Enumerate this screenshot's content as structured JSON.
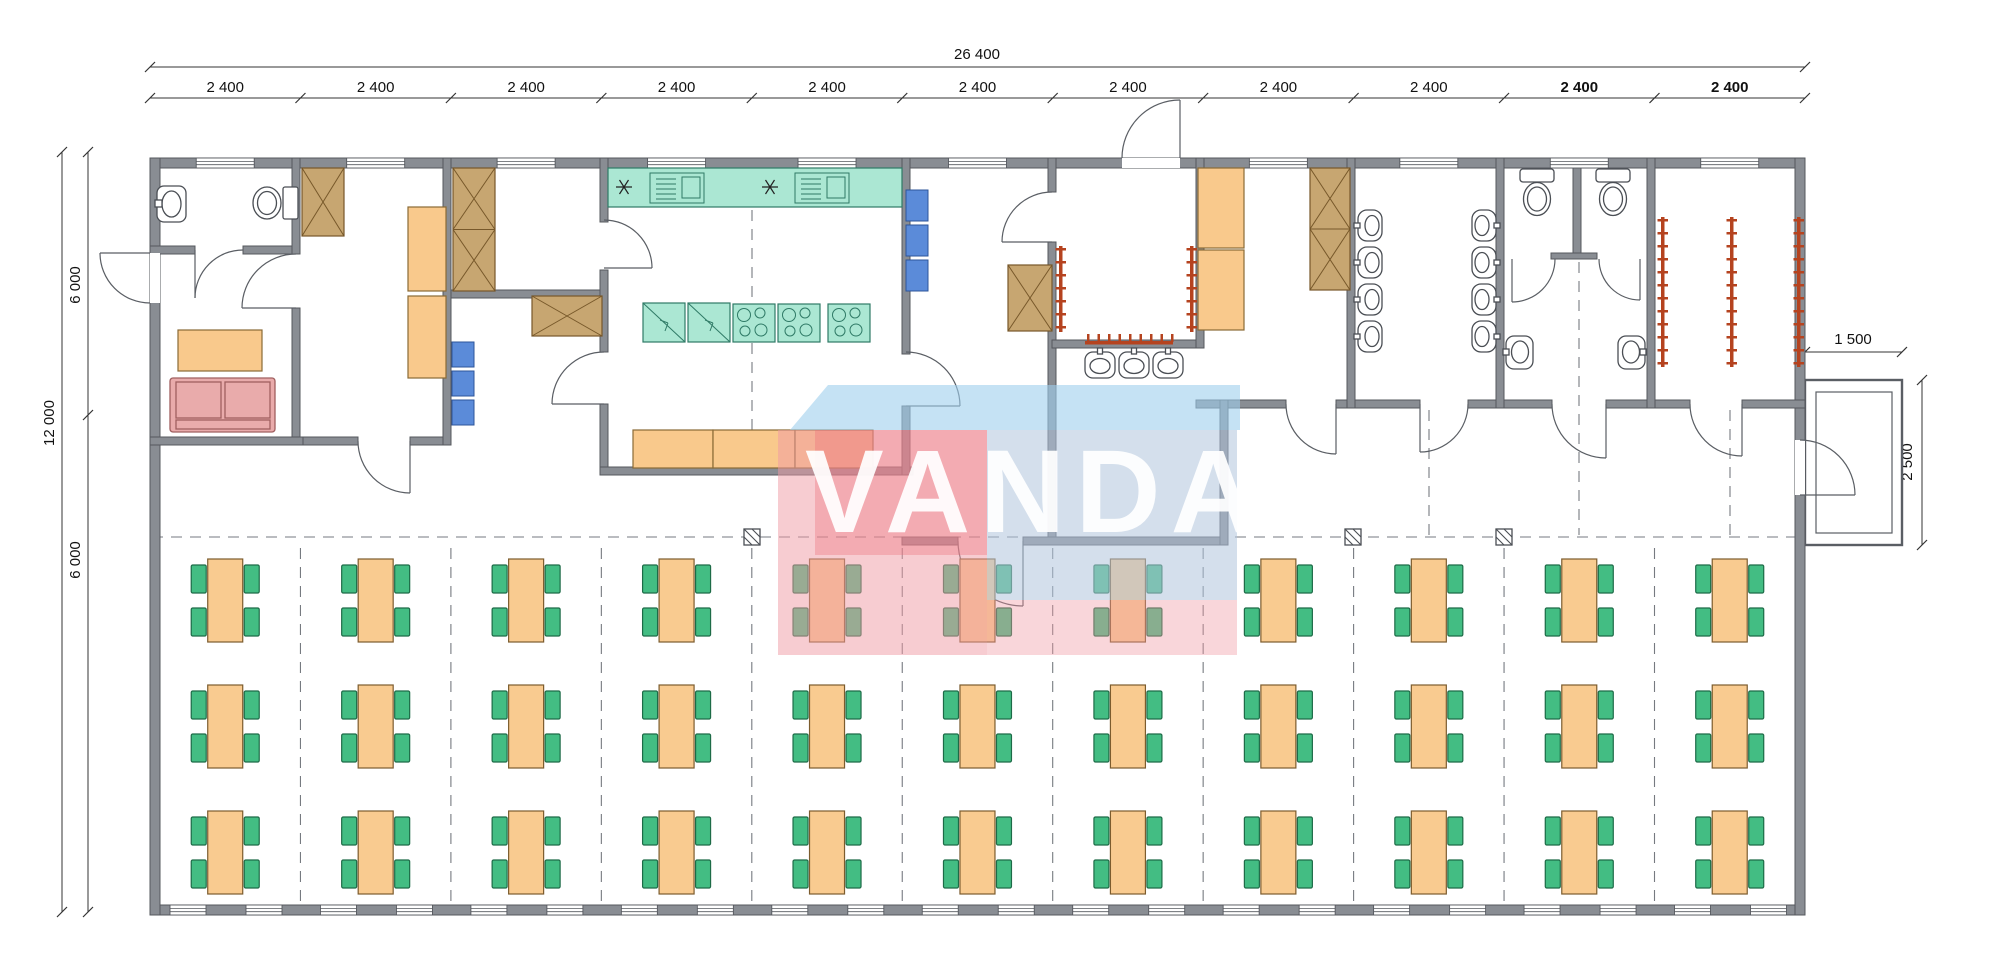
{
  "dimensions": {
    "overall_width": "26 400",
    "bay_width_labels": [
      "2 400",
      "2 400",
      "2 400",
      "2 400",
      "2 400",
      "2 400",
      "2 400",
      "2 400",
      "2 400",
      "2 400",
      "2 400"
    ],
    "overall_height": "12 000",
    "upper_zone_height": "6 000",
    "lower_zone_height": "6 000",
    "porch_depth": "1 500",
    "porch_width": "2 500"
  },
  "watermark": {
    "text": "VANDA"
  },
  "dining": {
    "columns": 11,
    "rows": 3,
    "chairs_per_table": 4
  },
  "colors": {
    "wall": "#898d93",
    "kitchen_equipment": "#abe7d3",
    "wood_furniture": "#f9c98c",
    "wardrobe": "#c7a671",
    "sofa": "#e9abab",
    "shelf_blue": "#5b8bd9",
    "chair_green": "#43bd83",
    "coat_rack_red": "#b5431f",
    "watermark_pink": "#f099a3",
    "watermark_blue": "#b0c4dc",
    "watermark_light_blue": "#9eceec"
  }
}
